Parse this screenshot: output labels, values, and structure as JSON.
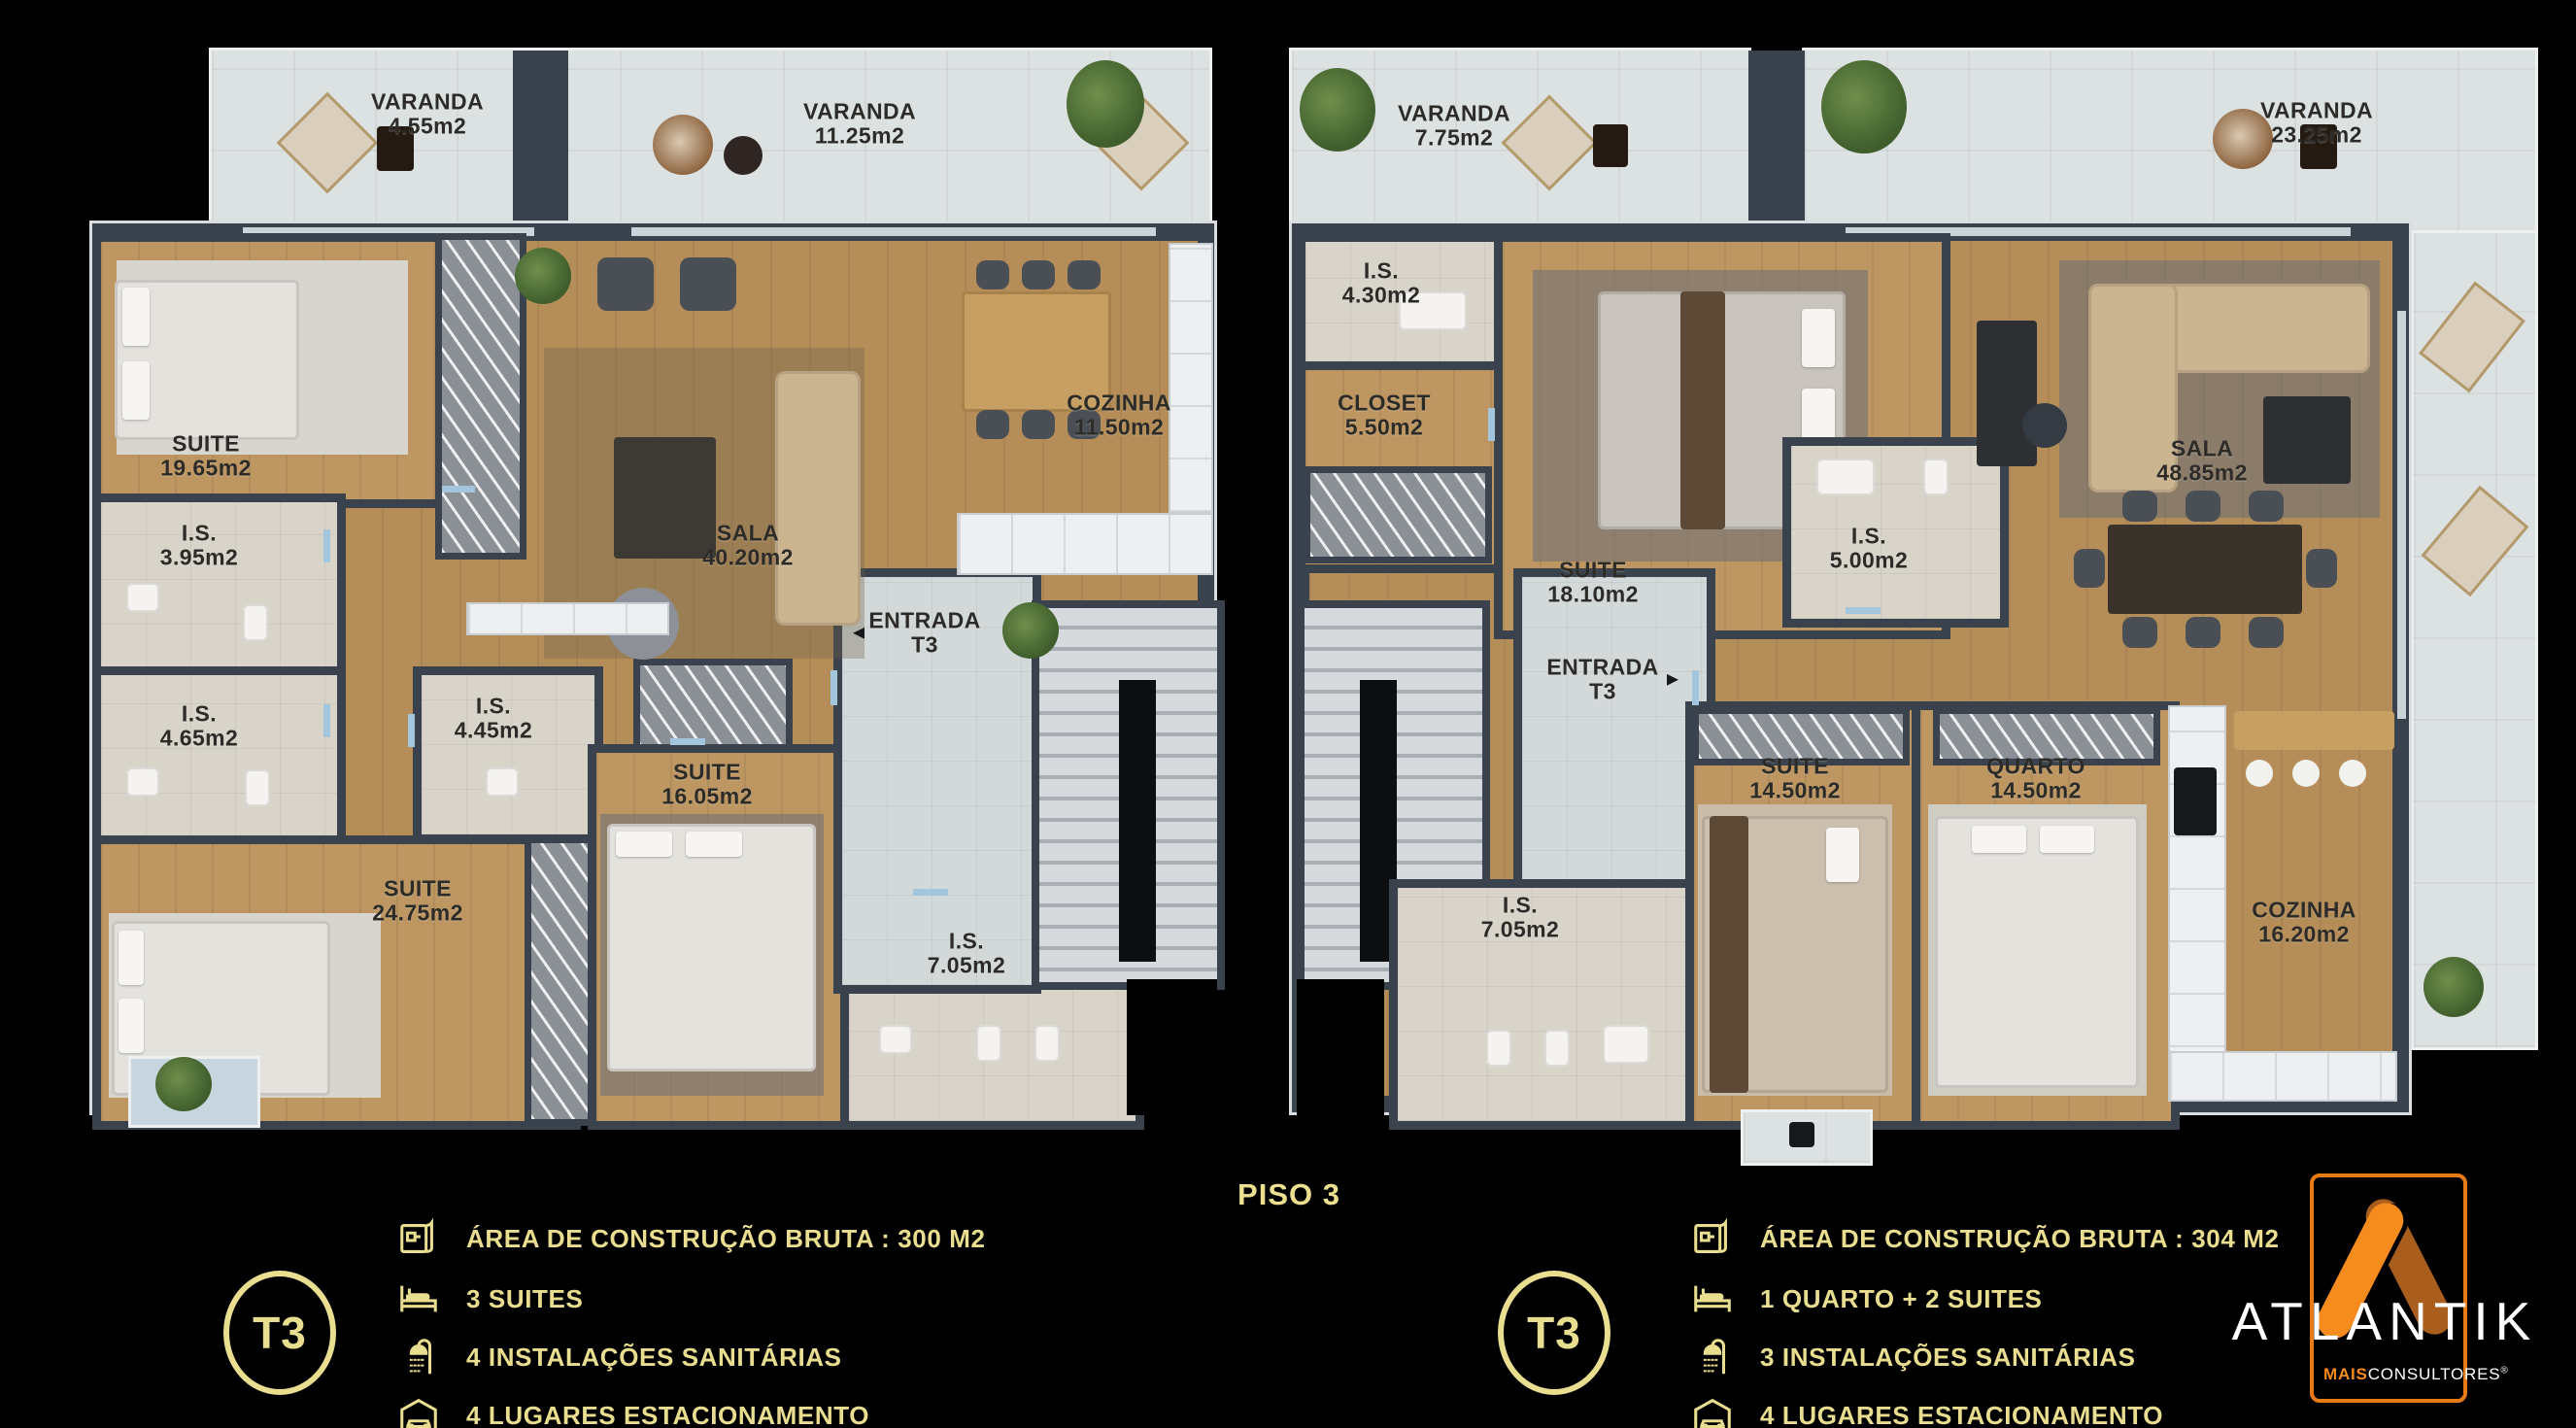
{
  "floor_title": "PISO 3",
  "colors": {
    "wall": "#39424d",
    "wood": "#b48d58",
    "tile": "#d8d4ca",
    "gold": "#e9dd8f",
    "orange": "#f78c1e",
    "background": "#000000"
  },
  "rooms": {
    "va": {
      "name": "VARANDA",
      "area": "4.55m2"
    },
    "vb": {
      "name": "VARANDA",
      "area": "11.25m2"
    },
    "vc": {
      "name": "VARANDA",
      "area": "7.75m2"
    },
    "vd": {
      "name": "VARANDA",
      "area": "23.25m2"
    },
    "suite1965": {
      "name": "SUITE",
      "area": "19.65m2"
    },
    "is395": {
      "name": "I.S.",
      "area": "3.95m2"
    },
    "is465": {
      "name": "I.S.",
      "area": "4.65m2"
    },
    "suite2475": {
      "name": "SUITE",
      "area": "24.75m2"
    },
    "sala4020": {
      "name": "SALA",
      "area": "40.20m2"
    },
    "cozinha1150": {
      "name": "COZINHA",
      "area": "11.50m2"
    },
    "is445": {
      "name": "I.S.",
      "area": "4.45m2"
    },
    "suite1605": {
      "name": "SUITE",
      "area": "16.05m2"
    },
    "is705l": {
      "name": "I.S.",
      "area": "7.05m2"
    },
    "entradal": {
      "name": "ENTRADA",
      "sub": "T3",
      "arrow": "◄"
    },
    "is430": {
      "name": "I.S.",
      "area": "4.30m2"
    },
    "closet550": {
      "name": "CLOSET",
      "area": "5.50m2"
    },
    "suite1810": {
      "name": "SUITE",
      "area": "18.10m2"
    },
    "is500": {
      "name": "I.S.",
      "area": "5.00m2"
    },
    "sala4885": {
      "name": "SALA",
      "area": "48.85m2"
    },
    "entradar": {
      "name": "ENTRADA",
      "sub": "T3",
      "arrow": "►"
    },
    "suite1450": {
      "name": "SUITE",
      "area": "14.50m2"
    },
    "quarto1450": {
      "name": "QUARTO",
      "area": "14.50m2"
    },
    "cozinha1620": {
      "name": "COZINHA",
      "area": "16.20m2"
    },
    "is705r": {
      "name": "I.S.",
      "area": "7.05m2"
    }
  },
  "legend_left": {
    "badge": "T3",
    "items": [
      {
        "icon": "blueprint-icon",
        "text": "ÁREA DE CONSTRUÇÃO BRUTA :  300 M2"
      },
      {
        "icon": "bed-icon",
        "text": "3 SUITES"
      },
      {
        "icon": "shower-icon",
        "text": "4 INSTALAÇÕES SANITÁRIAS"
      },
      {
        "icon": "car-garage-icon",
        "text": "4 LUGARES ESTACIONAMENTO"
      }
    ]
  },
  "legend_right": {
    "badge": "T3",
    "items": [
      {
        "icon": "blueprint-icon",
        "text": "ÁREA DE CONSTRUÇÃO BRUTA :  304 M2"
      },
      {
        "icon": "bed-icon",
        "text": "1 QUARTO + 2 SUITES"
      },
      {
        "icon": "shower-icon",
        "text": "3 INSTALAÇÕES SANITÁRIAS"
      },
      {
        "icon": "car-garage-icon",
        "text": "4 LUGARES ESTACIONAMENTO"
      }
    ]
  },
  "logo": {
    "brand": "ATLANTIK",
    "mais": "MAIS",
    "consultores": "CONSULTORES",
    "reg": "®"
  }
}
